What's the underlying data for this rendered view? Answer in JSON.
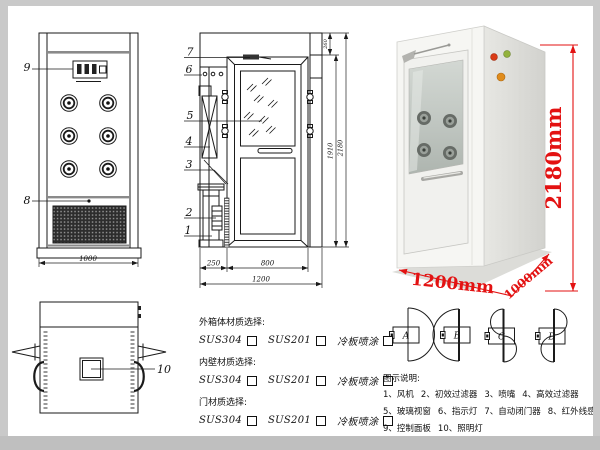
{
  "front_view": {
    "callout_control_panel": "9",
    "callout_grille": "8",
    "dim_width": "1000"
  },
  "side_view": {
    "callouts": [
      "7",
      "6",
      "5",
      "4",
      "3",
      "2",
      "1"
    ],
    "dims": {
      "top": "260",
      "door_height": "1910",
      "total_height": "2180",
      "left_section": "250",
      "door_width": "800",
      "total_width": "1200"
    }
  },
  "top_view": {
    "callout_lamp": "10"
  },
  "photo": {
    "height_label": "2180mm",
    "width_label": "1200mm",
    "depth_label": "1000mm"
  },
  "materials": {
    "sections": [
      {
        "title": "外箱体材质选择:",
        "options": [
          "SUS304",
          "SUS201",
          "冷板喷涂"
        ]
      },
      {
        "title": "内壁材质选择:",
        "options": [
          "SUS304",
          "SUS201",
          "冷板喷涂"
        ]
      },
      {
        "title": "门材质选择:",
        "options": [
          "SUS304",
          "SUS201",
          "冷板喷涂"
        ]
      }
    ]
  },
  "door_types": [
    "A",
    "B",
    "C",
    "D"
  ],
  "legend": {
    "title": "图示说明:",
    "items": [
      "1、风机",
      "2、初效过滤器",
      "3、喷嘴",
      "4、高效过滤器",
      "5、玻璃视窗",
      "6、指示灯",
      "7、自动闭门器",
      "8、红外线感应器",
      "9、控制面板",
      "10、照明灯"
    ]
  },
  "colors": {
    "dimension_red": "#e31212",
    "line_black": "#1a1a1a",
    "frame_gray": "#c9c9c9"
  }
}
